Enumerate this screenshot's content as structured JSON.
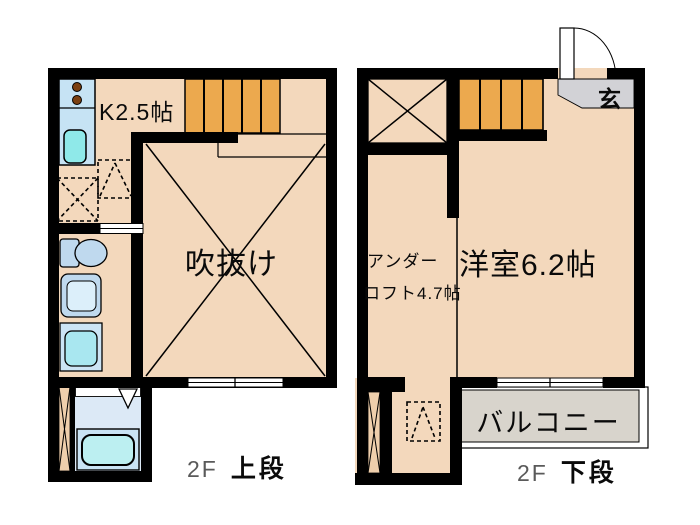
{
  "left_plan": {
    "caption_floor": "2F",
    "caption_level": "上段",
    "rooms": {
      "kitchen": "K2.5帖",
      "void": "吹抜け"
    }
  },
  "right_plan": {
    "caption_floor": "2F",
    "caption_level": "下段",
    "rooms": {
      "under_line1": "アンダー",
      "under_line2": "ロフト4.7帖",
      "western_room": "洋室6.2帖",
      "entrance": "玄",
      "balcony": "バルコニー"
    }
  },
  "colors": {
    "floor_beige": "#F3D8BC",
    "wall_black": "#000000",
    "stairs_orange": "#ECA94E",
    "fixture_blue": "#BFD9EE",
    "counter_blue": "#C6E3F4",
    "sink_cyan": "#8FE9E9",
    "tub_cyan": "#BCEFF1",
    "bath_floor_blue": "#DCE9F6",
    "entrance_gray": "#D2D2D6",
    "balcony_gray": "#D8D4CC",
    "shaft_tan": "#EFCFAC",
    "burner_brown": "#7B3F10"
  }
}
